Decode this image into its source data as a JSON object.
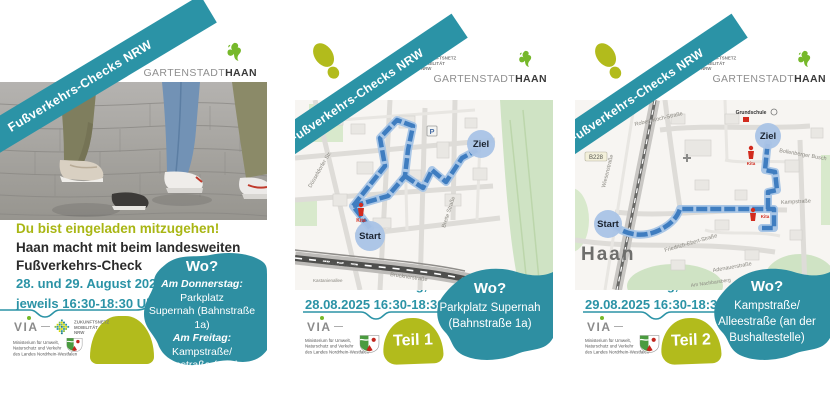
{
  "colors": {
    "teal": "#2b93a6",
    "olive": "#b2bb1c",
    "route_blue": "#3f7dc0",
    "haan_green": "#76b82a",
    "map_green": "#cfe3c4",
    "marker_blue": "#a9c3e6",
    "kita_red": "#d22b1e"
  },
  "shared": {
    "banner": "Fußverkehrs-Checks NRW",
    "gartenstadt": "GARTENSTADT",
    "haan": "HAAN",
    "znm": {
      "l1": "ZUKUNFTSNETZ",
      "l2": "MOBILITÄT",
      "l3": "NRW"
    },
    "via": "VIA",
    "ministry": {
      "l1": "Ministerium für Umwelt,",
      "l2": "Naturschutz und Verkehr",
      "l3": "des Landes Nordrhein-Westfalen"
    }
  },
  "flyer1": {
    "headline": "Du bist eingeladen mitzugehen!",
    "sub1": "Haan macht mit beim landesweiten",
    "sub2": "Fußverkehrs-Check",
    "date1": "28. und 29. August 2025",
    "date2": "jeweils 16:30-18:30 Uhr",
    "wo_title": "Wo?",
    "wo": {
      "d1b": "Am Donnerstag:",
      "d1t": " Parkplatz",
      "d2": "Supernah (Bahnstraße 1a)",
      "d3b": "Am Freitag:",
      "d3t": " Kampstraße/",
      "d4": "Alleestraße (an der",
      "d5": "Bushaltestelle)"
    }
  },
  "flyer2": {
    "wann1": "Wann? Donnerstag,",
    "wann2": "28.08.2025 16:30-18:30 Uhr",
    "teil": "Teil 1",
    "wo_title": "Wo?",
    "wo1": "Parkplatz Supernah",
    "wo2": "(Bahnstraße 1a)",
    "map": {
      "start": "Start",
      "ziel": "Ziel",
      "kita": "Kita",
      "p": "P",
      "breite": "Breite Straße",
      "bruckner": "Brucknerstraße",
      "bahn": "Haan-Gruiten",
      "duesseldorfer": "Düsseldorfer Str.",
      "kastanien": "Kastanienallee"
    }
  },
  "flyer3": {
    "wann1": "Wann? Freitag,",
    "wann2": "29.08.2025 16:30-18:30 Uhr",
    "teil": "Teil 2",
    "wo_title": "Wo?",
    "wo1": "Kampstraße/",
    "wo2": "Alleestraße (an der",
    "wo3": "Bushaltestelle)",
    "map": {
      "start": "Start",
      "ziel": "Ziel",
      "kita": "Kita",
      "haan": "Haan",
      "grundschule": "Grundschule",
      "robert": "Robert-Koch-Straße",
      "friedrich": "Friedrich-Ebert-Straße",
      "adenauer": "Adenauerstraße",
      "kamp": "Kampstraße",
      "wiesen": "Wiesenstraße",
      "b228": "B228",
      "bollenberg": "Bollenberger Busch",
      "nachbarsberg": "Am Nachbarsberg"
    }
  }
}
